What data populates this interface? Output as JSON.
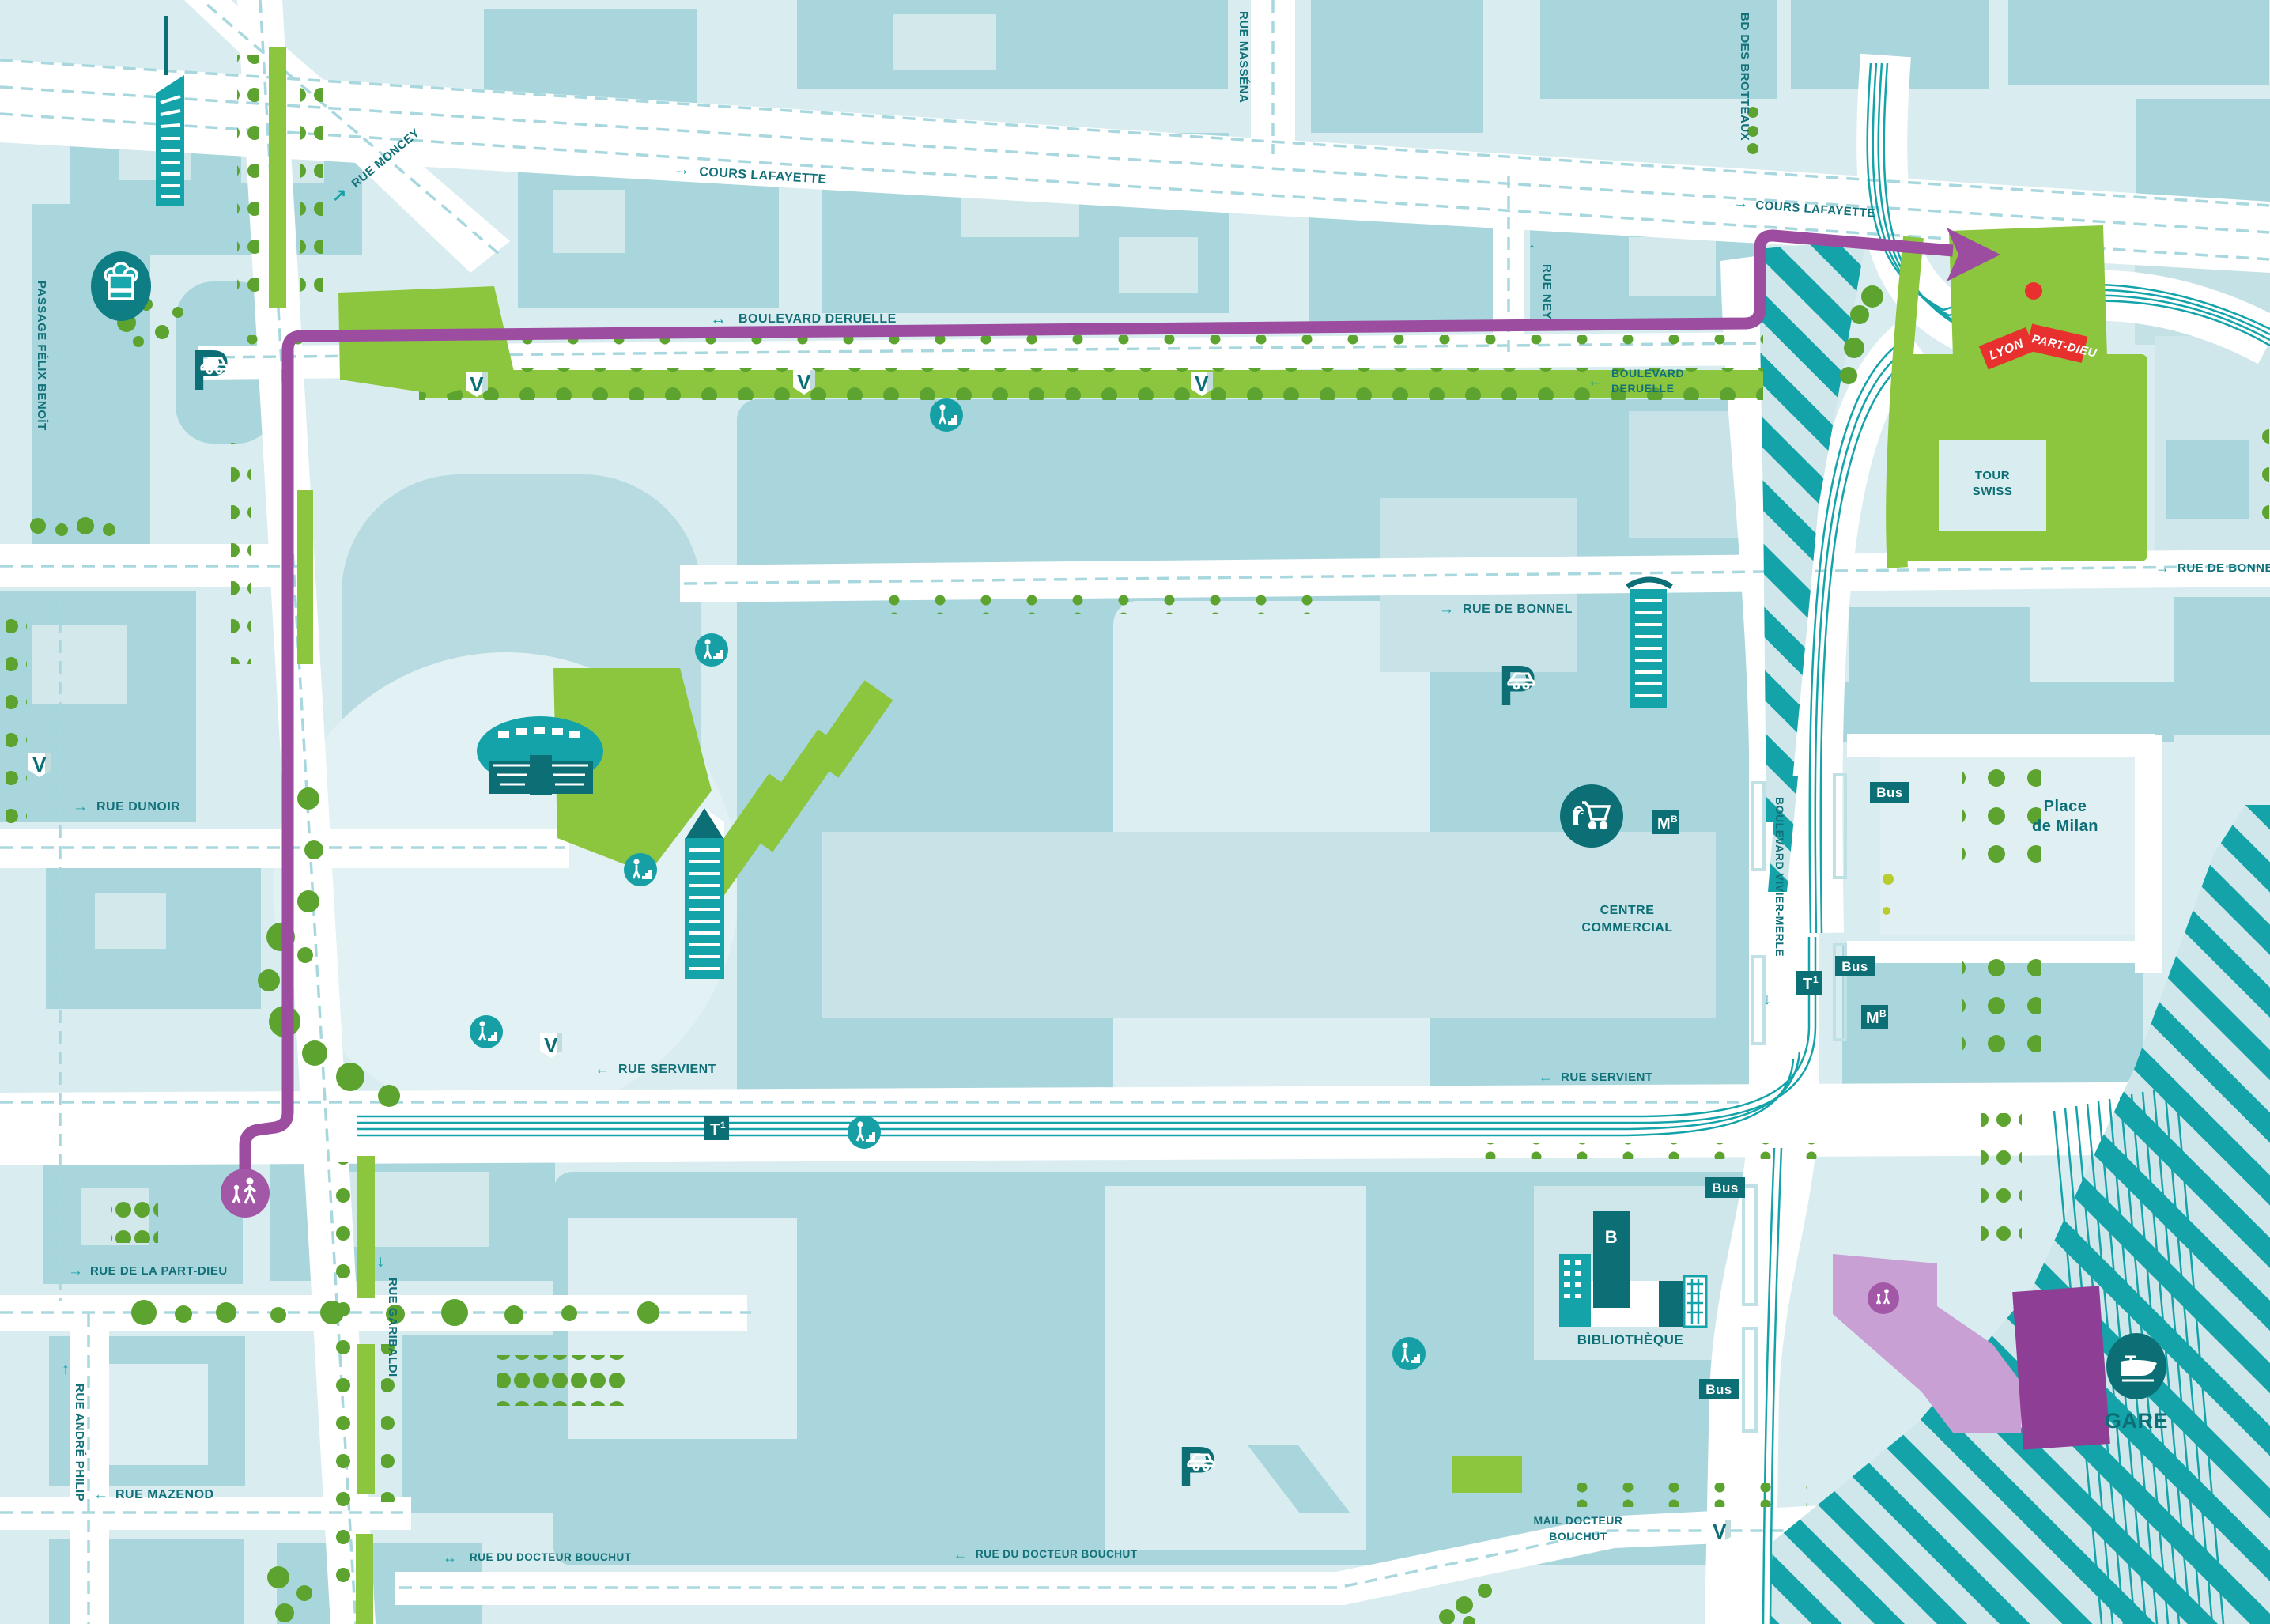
{
  "map": {
    "streets": {
      "passage_felix_benoit": "PASSAGE FÉLIX BENOÎT",
      "rue_moncey": "RUE MONCEY",
      "cours_lafayette": "COURS LAFAYETTE",
      "rue_massena": "RUE MASSÉNA",
      "bd_des_brotteaux": "BD DES BROTTEAUX",
      "rue_ney": "RUE NEY",
      "boulevard_deruelle": "BOULEVARD DERUELLE",
      "boulevard_deruelle_l1": "BOULEVARD",
      "boulevard_deruelle_l2": "DERUELLE",
      "rue_de_bonnel": "RUE DE BONNEL",
      "rue_dunoir": "RUE DUNOIR",
      "rue_servient": "RUE SERVIENT",
      "rue_garibaldi": "RUE GARIBALDI",
      "rue_de_la_part_dieu": "RUE DE LA PART-DIEU",
      "rue_andre_philip": "RUE ANDRÉ PHILIP",
      "rue_mazenod": "RUE MAZENOD",
      "rue_du_docteur_bouchut": "RUE DU DOCTEUR BOUCHUT",
      "mail_docteur_bouchut_l1": "MAIL DOCTEUR",
      "mail_docteur_bouchut_l2": "BOUCHUT",
      "boulevard_vivier_merle": "BOULEVARD VIVIER-MERLE"
    },
    "places": {
      "tour_swiss_l1": "TOUR",
      "tour_swiss_l2": "SWISS",
      "place_de_milan_l1": "Place",
      "place_de_milan_l2": "de Milan",
      "centre_commercial_l1": "CENTRE",
      "centre_commercial_l2": "COMMERCIAL",
      "bibliotheque": "BIBLIOTHÈQUE",
      "gare": "GARE"
    },
    "signs": {
      "lyon": "LYON",
      "part_dieu": "PART-DIEU"
    },
    "badges": {
      "bus": "Bus",
      "tram": "T",
      "tram_sup": "1",
      "metro": "M",
      "metro_sup": "B",
      "velov": "V",
      "parking": "P",
      "bibliotheque_initial": "B"
    },
    "arrows": {
      "right": "→",
      "left": "←",
      "both": "↔",
      "up": "↑",
      "down": "↓",
      "up_right": "↗"
    },
    "colors": {
      "route_purple": "#9c4da0",
      "corridor_lavender": "#c9a0d3",
      "station_purple": "#8f3e96",
      "rail_teal": "#14a3a9",
      "icon_teal": "#0d6f76",
      "label_teal": "#127078",
      "green_light": "#8cc63f",
      "green_dark": "#5ca32f",
      "sign_red": "#e8312e",
      "building": "#a9d6dc",
      "block": "#cfe7ea",
      "road": "#ffffff"
    }
  }
}
